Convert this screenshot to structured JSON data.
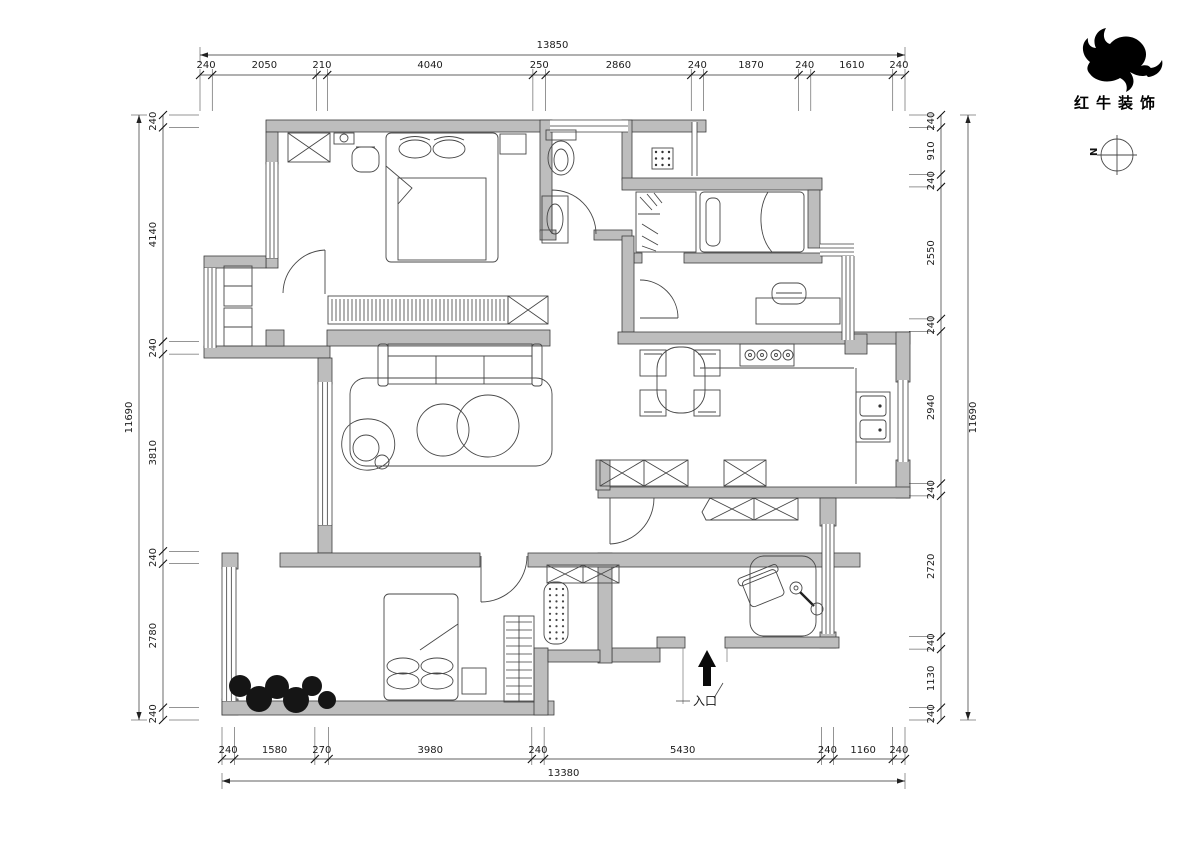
{
  "company": {
    "name": "红牛装饰"
  },
  "compass": {
    "north": "N"
  },
  "plan": {
    "entry_label": "入口"
  },
  "dims": {
    "top": {
      "total": "13850",
      "segments": [
        "240",
        "2050",
        "210",
        "4040",
        "250",
        "2860",
        "240",
        "1870",
        "240",
        "1610",
        "240"
      ]
    },
    "bottom": {
      "total": "13380",
      "segments": [
        "240",
        "1580",
        "270",
        "3980",
        "240",
        "5430",
        "240",
        "1160",
        "240"
      ]
    },
    "left": {
      "total": "11690",
      "segments": [
        "240",
        "4140",
        "240",
        "3810",
        "240",
        "2780",
        "240"
      ]
    },
    "right": {
      "total": "11690",
      "segments": [
        "240",
        "910",
        "240",
        "2550",
        "240",
        "2940",
        "240",
        "2720",
        "240",
        "1130",
        "240"
      ]
    }
  },
  "titleblock": {
    "client_label": "CLIENT",
    "client_value": "李先生",
    "design_firm_label": "DESIGN FIRM",
    "design_firm_value": "南京红牛装饰",
    "project_label_1": "PROJECT",
    "project_label_2": "PROJECT",
    "project_value": "紫气钟山",
    "revision_label": "REVISION",
    "date_label": "DATE",
    "by_label": "BY",
    "signed_off_label": "SIGNED OFF",
    "project_leader_label": "PROJECT LEADER",
    "checked_label": "CHECKED",
    "approved_label": "APPROVED",
    "project_designer_label": "PROJECT DESIGNER",
    "drawing_label": "DRAWING",
    "drawing_title_label": "DRAWING TITLE",
    "stage_label": "STAGE",
    "stage_value": "施工图纸",
    "scale_label": "SCALE",
    "scale_value": "1:100@A3",
    "date2_label": "DATE",
    "date2_value": "2024",
    "job_no_label": "JOB NO.",
    "drawing_no_label": "DRAWING NO.",
    "page_no_label": "PAGE NO."
  }
}
